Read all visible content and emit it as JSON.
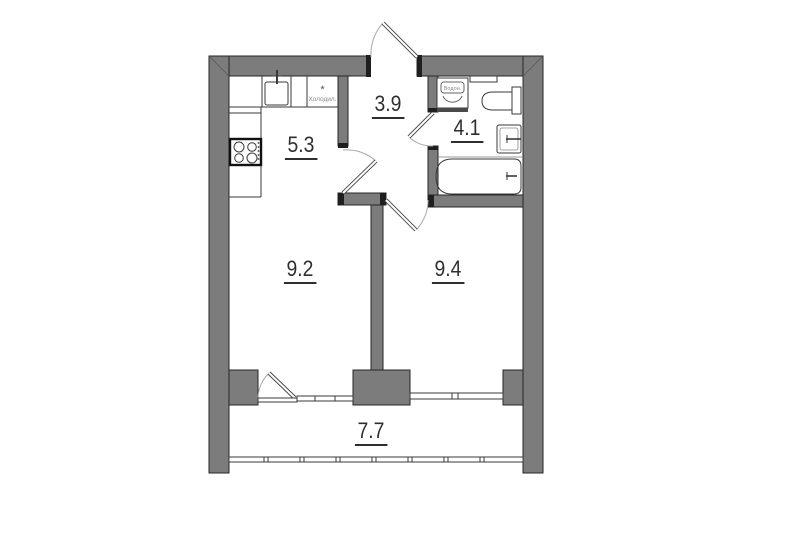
{
  "plan": {
    "background": "#ffffff",
    "wall_color": "#7c7c7c",
    "line_color": "#3a3a3a"
  },
  "rooms": {
    "kitchen": {
      "area": "5.3"
    },
    "hallway": {
      "area": "3.9"
    },
    "bathroom": {
      "area": "4.1"
    },
    "living_room": {
      "area": "9.2"
    },
    "bedroom": {
      "area": "9.4"
    },
    "balcony": {
      "area": "7.7"
    }
  },
  "appliances": {
    "fridge": {
      "symbol": "*",
      "label": "Холодил."
    },
    "water_heater": {
      "label": "Водон."
    }
  }
}
